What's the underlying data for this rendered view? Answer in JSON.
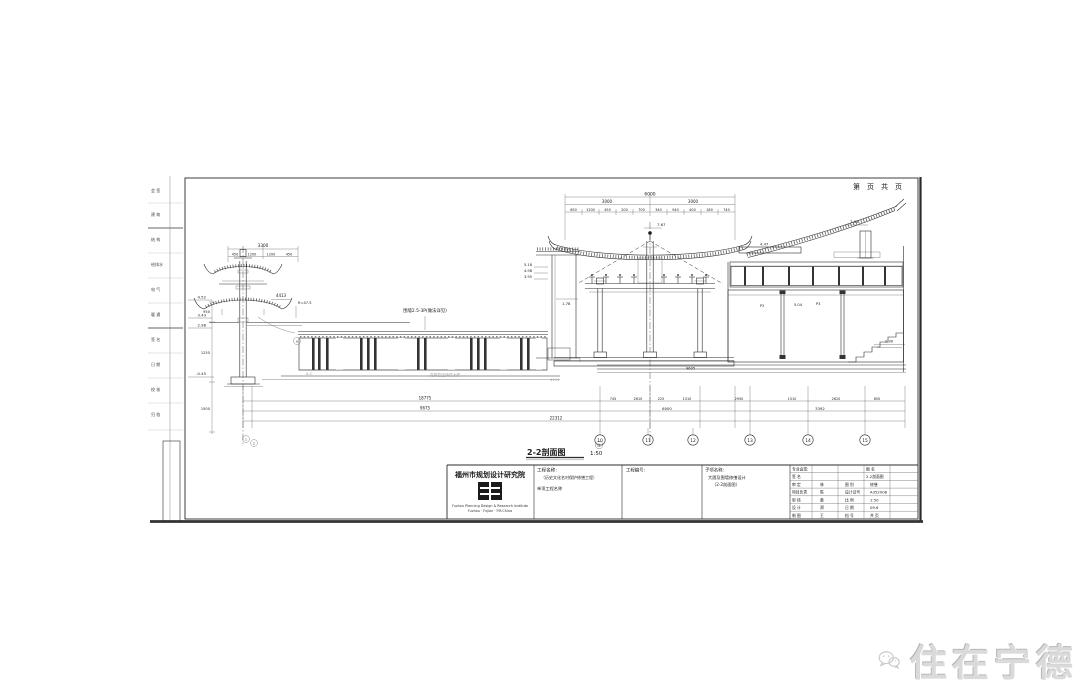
{
  "watermark": {
    "text": "住在宁德"
  },
  "sheet": {
    "page_note": "第　页　共　页",
    "section_title": "2-2剖面图",
    "section_scale": "1:50",
    "revision_mark": "改",
    "edge_stamps": [
      "会 签",
      "建 筑",
      "结 构",
      "给排水",
      "电 气",
      "暖 通",
      "签 名",
      "日 期",
      "校 核",
      "归 档"
    ]
  },
  "title_block": {
    "institute": "福州市规划设计研究院",
    "institute_en1": "Fuzhou Planning Design & Research Institute",
    "institute_en2": "Fuzhou · Fujian · P.R.China",
    "project_label": "工程名称:",
    "project_name": "（历史文化名村保护修缮工程）",
    "sub_project_label": "单项工程名称",
    "job_no_label": "工程编号:",
    "sheet_name_label": "子项名称:",
    "sheet_name_1": "大厝及围墙修缮设计",
    "sheet_name_2": "（2-2剖面图）",
    "grid": [
      [
        "专业会签:",
        "",
        "图 名",
        ""
      ],
      [
        "签  名",
        "",
        "2-2剖面图",
        ""
      ],
      [
        "审  定",
        "林",
        "图 别",
        "修缮"
      ],
      [
        "项目负责",
        "陈",
        "设计证号",
        "A352008"
      ],
      [
        "审  核",
        "黄",
        "比 例",
        "1:50"
      ],
      [
        "设  计",
        "郑",
        "日 期",
        "09.6"
      ],
      [
        "制  图",
        "王",
        "档 号",
        "共  页"
      ]
    ]
  },
  "drawing": {
    "pavilion": {
      "dim_total": "3300",
      "dim_subs": [
        "450",
        "1200",
        "1200",
        "450"
      ],
      "elevations": [
        "4.52",
        "3.43",
        "2.98"
      ],
      "ground_elev": "-0.45",
      "v_dims": [
        "950",
        "1255",
        "1500"
      ],
      "note_box": "4413",
      "note_r": "R=47.5"
    },
    "fence": {
      "label": "围墙2.5-3P(做法详见)",
      "notes": [
        "A.C",
        "花岗岩压顶详大样",
        "4111"
      ],
      "bubble": "6"
    },
    "hall": {
      "ridge_elev": "7.67",
      "dim_total": "6000",
      "dim_half_l": "3000",
      "dim_half_r": "3000",
      "dim_subs": [
        "650",
        "1200",
        "450",
        "200",
        "700",
        "340",
        "940",
        "400",
        "180",
        "740"
      ],
      "wing_elevs": [
        "5.18",
        "4.98",
        "3.95"
      ],
      "wing_note": "1.78"
    },
    "right_hall": {
      "fascia_elev": "4.47",
      "top_elev": "7.05",
      "floor_elev": "2.30",
      "notes": [
        "P2",
        "5.04",
        "P3"
      ],
      "base_note": "9605"
    },
    "dims": {
      "row_a": [
        "18775",
        "745",
        "2610",
        "225",
        "1510",
        "2950",
        "1510",
        "2620",
        "650"
      ],
      "row_b": [
        "9675",
        "6000",
        "3392"
      ],
      "row_c": [
        "22312"
      ]
    },
    "axes": {
      "bubbles": [
        "10",
        "11",
        "12",
        "13",
        "14",
        "15"
      ],
      "pair": [
        "1",
        "2"
      ]
    }
  }
}
